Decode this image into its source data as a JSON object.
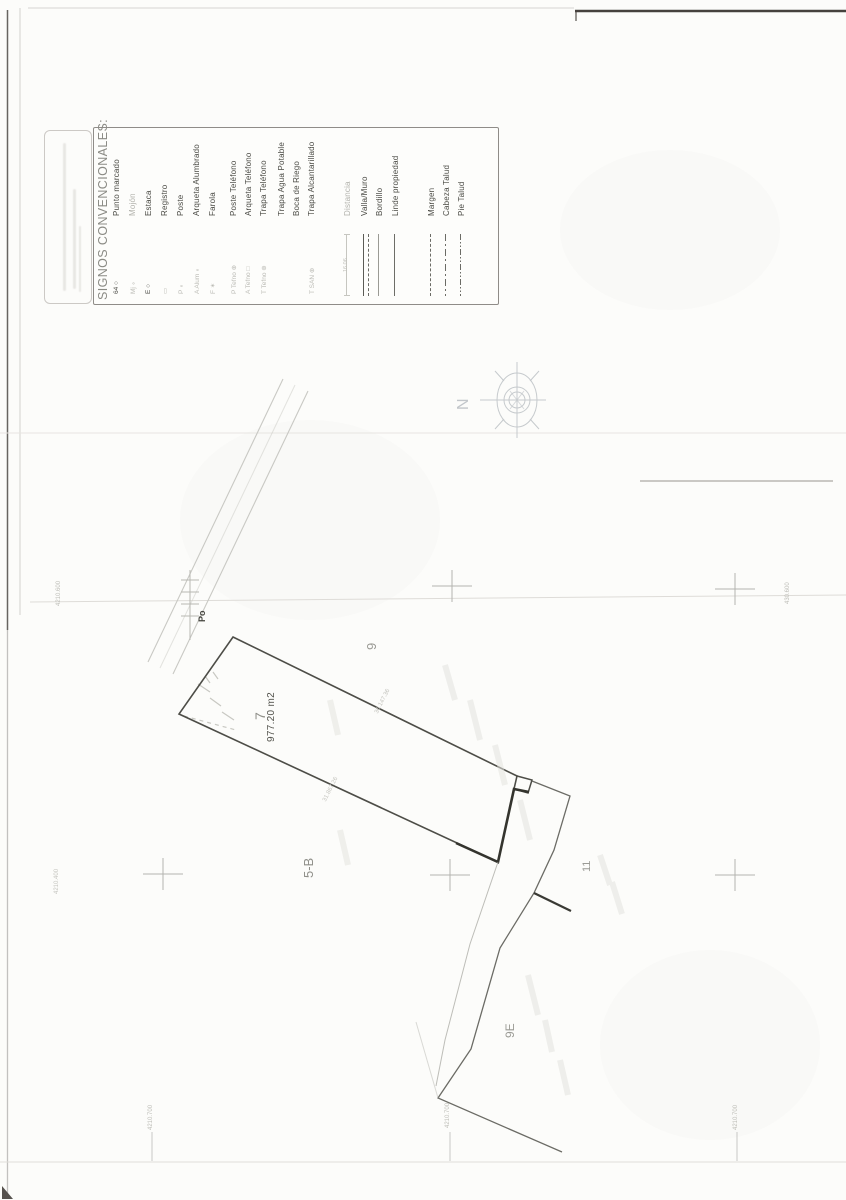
{
  "document": {
    "kind": "scanned cadastral plan",
    "colors": {
      "paper": "#fcfcfa",
      "ink_dark": "#4b4b45",
      "ink_faint": "#b3b3ad",
      "line": "#6b6b65"
    }
  },
  "legend": {
    "title": "SIGNOS CONVENCIONALES:",
    "distance_value": "16.06",
    "entries": [
      {
        "x": 115,
        "symbol": "64 ○",
        "label": "Punto marcado",
        "tone": "dark",
        "sym_tone": "dark",
        "line": ""
      },
      {
        "x": 131,
        "symbol": "Mj ∘",
        "label": "Mojón",
        "tone": "faint",
        "sym_tone": "faint",
        "line": ""
      },
      {
        "x": 147,
        "symbol": "E ○",
        "label": "Estaca",
        "tone": "dark",
        "sym_tone": "dark",
        "line": ""
      },
      {
        "x": 163,
        "symbol": "▭",
        "label": "Registro",
        "tone": "dark",
        "sym_tone": "faint",
        "line": ""
      },
      {
        "x": 179,
        "symbol": "P ∘",
        "label": "Poste",
        "tone": "dark",
        "sym_tone": "faint",
        "line": ""
      },
      {
        "x": 195,
        "symbol": "A Alum ∘",
        "label": "Arqueta Alumbrado",
        "tone": "dark",
        "sym_tone": "faint",
        "line": ""
      },
      {
        "x": 211,
        "symbol": "F ✶",
        "label": "Farola",
        "tone": "dark",
        "sym_tone": "faint",
        "line": ""
      },
      {
        "x": 232,
        "symbol": "P Tefno ⊕",
        "label": "Poste Teléfono",
        "tone": "dark",
        "sym_tone": "faint",
        "line": ""
      },
      {
        "x": 247,
        "symbol": "A Tefno □",
        "label": "Arqueta Teléfono",
        "tone": "dark",
        "sym_tone": "faint",
        "line": ""
      },
      {
        "x": 262,
        "symbol": "T Tefno ⊕",
        "label": "Trapa Teléfono",
        "tone": "dark",
        "sym_tone": "faint",
        "line": ""
      },
      {
        "x": 280,
        "symbol": "",
        "label": "Trapa Agua Potable",
        "tone": "dark",
        "sym_tone": "faint",
        "line": ""
      },
      {
        "x": 295,
        "symbol": "",
        "label": "Boca de Riego",
        "tone": "dark",
        "sym_tone": "faint",
        "line": ""
      },
      {
        "x": 310,
        "symbol": "T SAN ⊕",
        "label": "Trapa Alcantarillado",
        "tone": "dark",
        "sym_tone": "faint",
        "line": ""
      },
      {
        "x": 346,
        "symbol": "",
        "label": "Distancia",
        "tone": "faint",
        "sym_tone": "faint",
        "line": "distance"
      },
      {
        "x": 363,
        "symbol": "",
        "label": "Valla/Muro",
        "tone": "dark",
        "sym_tone": "dark",
        "line": "valla"
      },
      {
        "x": 378,
        "symbol": "",
        "label": "Bordillo",
        "tone": "dark",
        "sym_tone": "dark",
        "line": "bordillo"
      },
      {
        "x": 394,
        "symbol": "",
        "label": "Linde propiedad",
        "tone": "dark",
        "sym_tone": "dark",
        "line": "linde"
      },
      {
        "x": 430,
        "symbol": "",
        "label": "Margen",
        "tone": "dark",
        "sym_tone": "dark",
        "line": "margen"
      },
      {
        "x": 445,
        "symbol": "",
        "label": "Cabeza Talud",
        "tone": "dark",
        "sym_tone": "dark",
        "line": "cabeza"
      },
      {
        "x": 460,
        "symbol": "",
        "label": "Pie Talud",
        "tone": "dark",
        "sym_tone": "dark",
        "line": "pie"
      }
    ]
  },
  "map": {
    "compass": {
      "north": "N"
    },
    "road_label": "Po",
    "parcel7": {
      "number": "7",
      "area": "977.20 m2"
    },
    "neighbors": {
      "plot9": "9",
      "plot5b": "5-B",
      "plot11": "11",
      "plot9e": "9E"
    },
    "dimensions": {
      "top_edge": "36.147.36",
      "bottom_edge": "31.867.26"
    },
    "coords": {
      "left_top": "4210.600",
      "right_top": "430.600",
      "left_mid": "4210.400",
      "bottom_left": "4210.700",
      "bottom_center": "4210.700",
      "bottom_right": "4210.700"
    }
  }
}
